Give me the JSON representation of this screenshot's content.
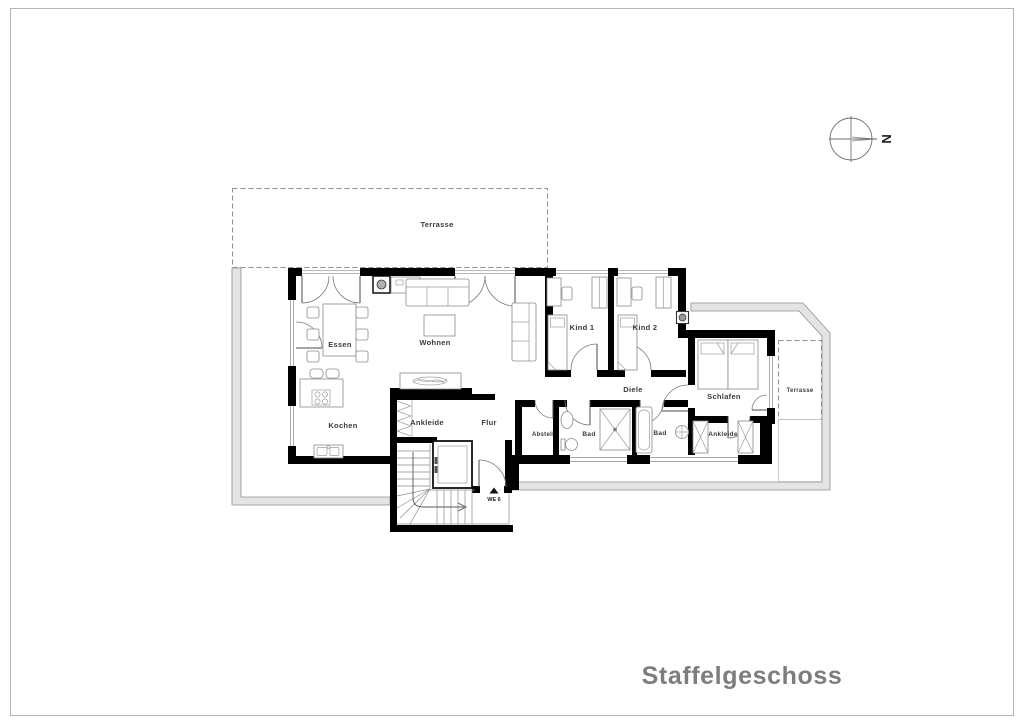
{
  "title": "Staffelgeschoss",
  "compass": {
    "north": "N"
  },
  "plan": {
    "entrance_label": "WE 6",
    "rooms": {
      "terrasse_top": "Terrasse",
      "essen": "Essen",
      "wohnen": "Wohnen",
      "kochen": "Kochen",
      "ankleide_west": "Ankleide",
      "flur": "Flur",
      "kind1": "Kind 1",
      "kind2": "Kind 2",
      "diele": "Diele",
      "schlafen": "Schlafen",
      "abstell": "Abstell",
      "bad_shower": "Bad",
      "bad_tub": "Bad",
      "ankleide_east": "Ankleide",
      "terrasse_east": "Terrasse"
    }
  },
  "colors": {
    "wall": "#000000",
    "footprint_fill": "#e4e4e4",
    "footprint_stroke": "#8f8f8f",
    "furniture": "#8a8a8a",
    "label": "#3a3a3a",
    "title": "#7d7d7d"
  }
}
